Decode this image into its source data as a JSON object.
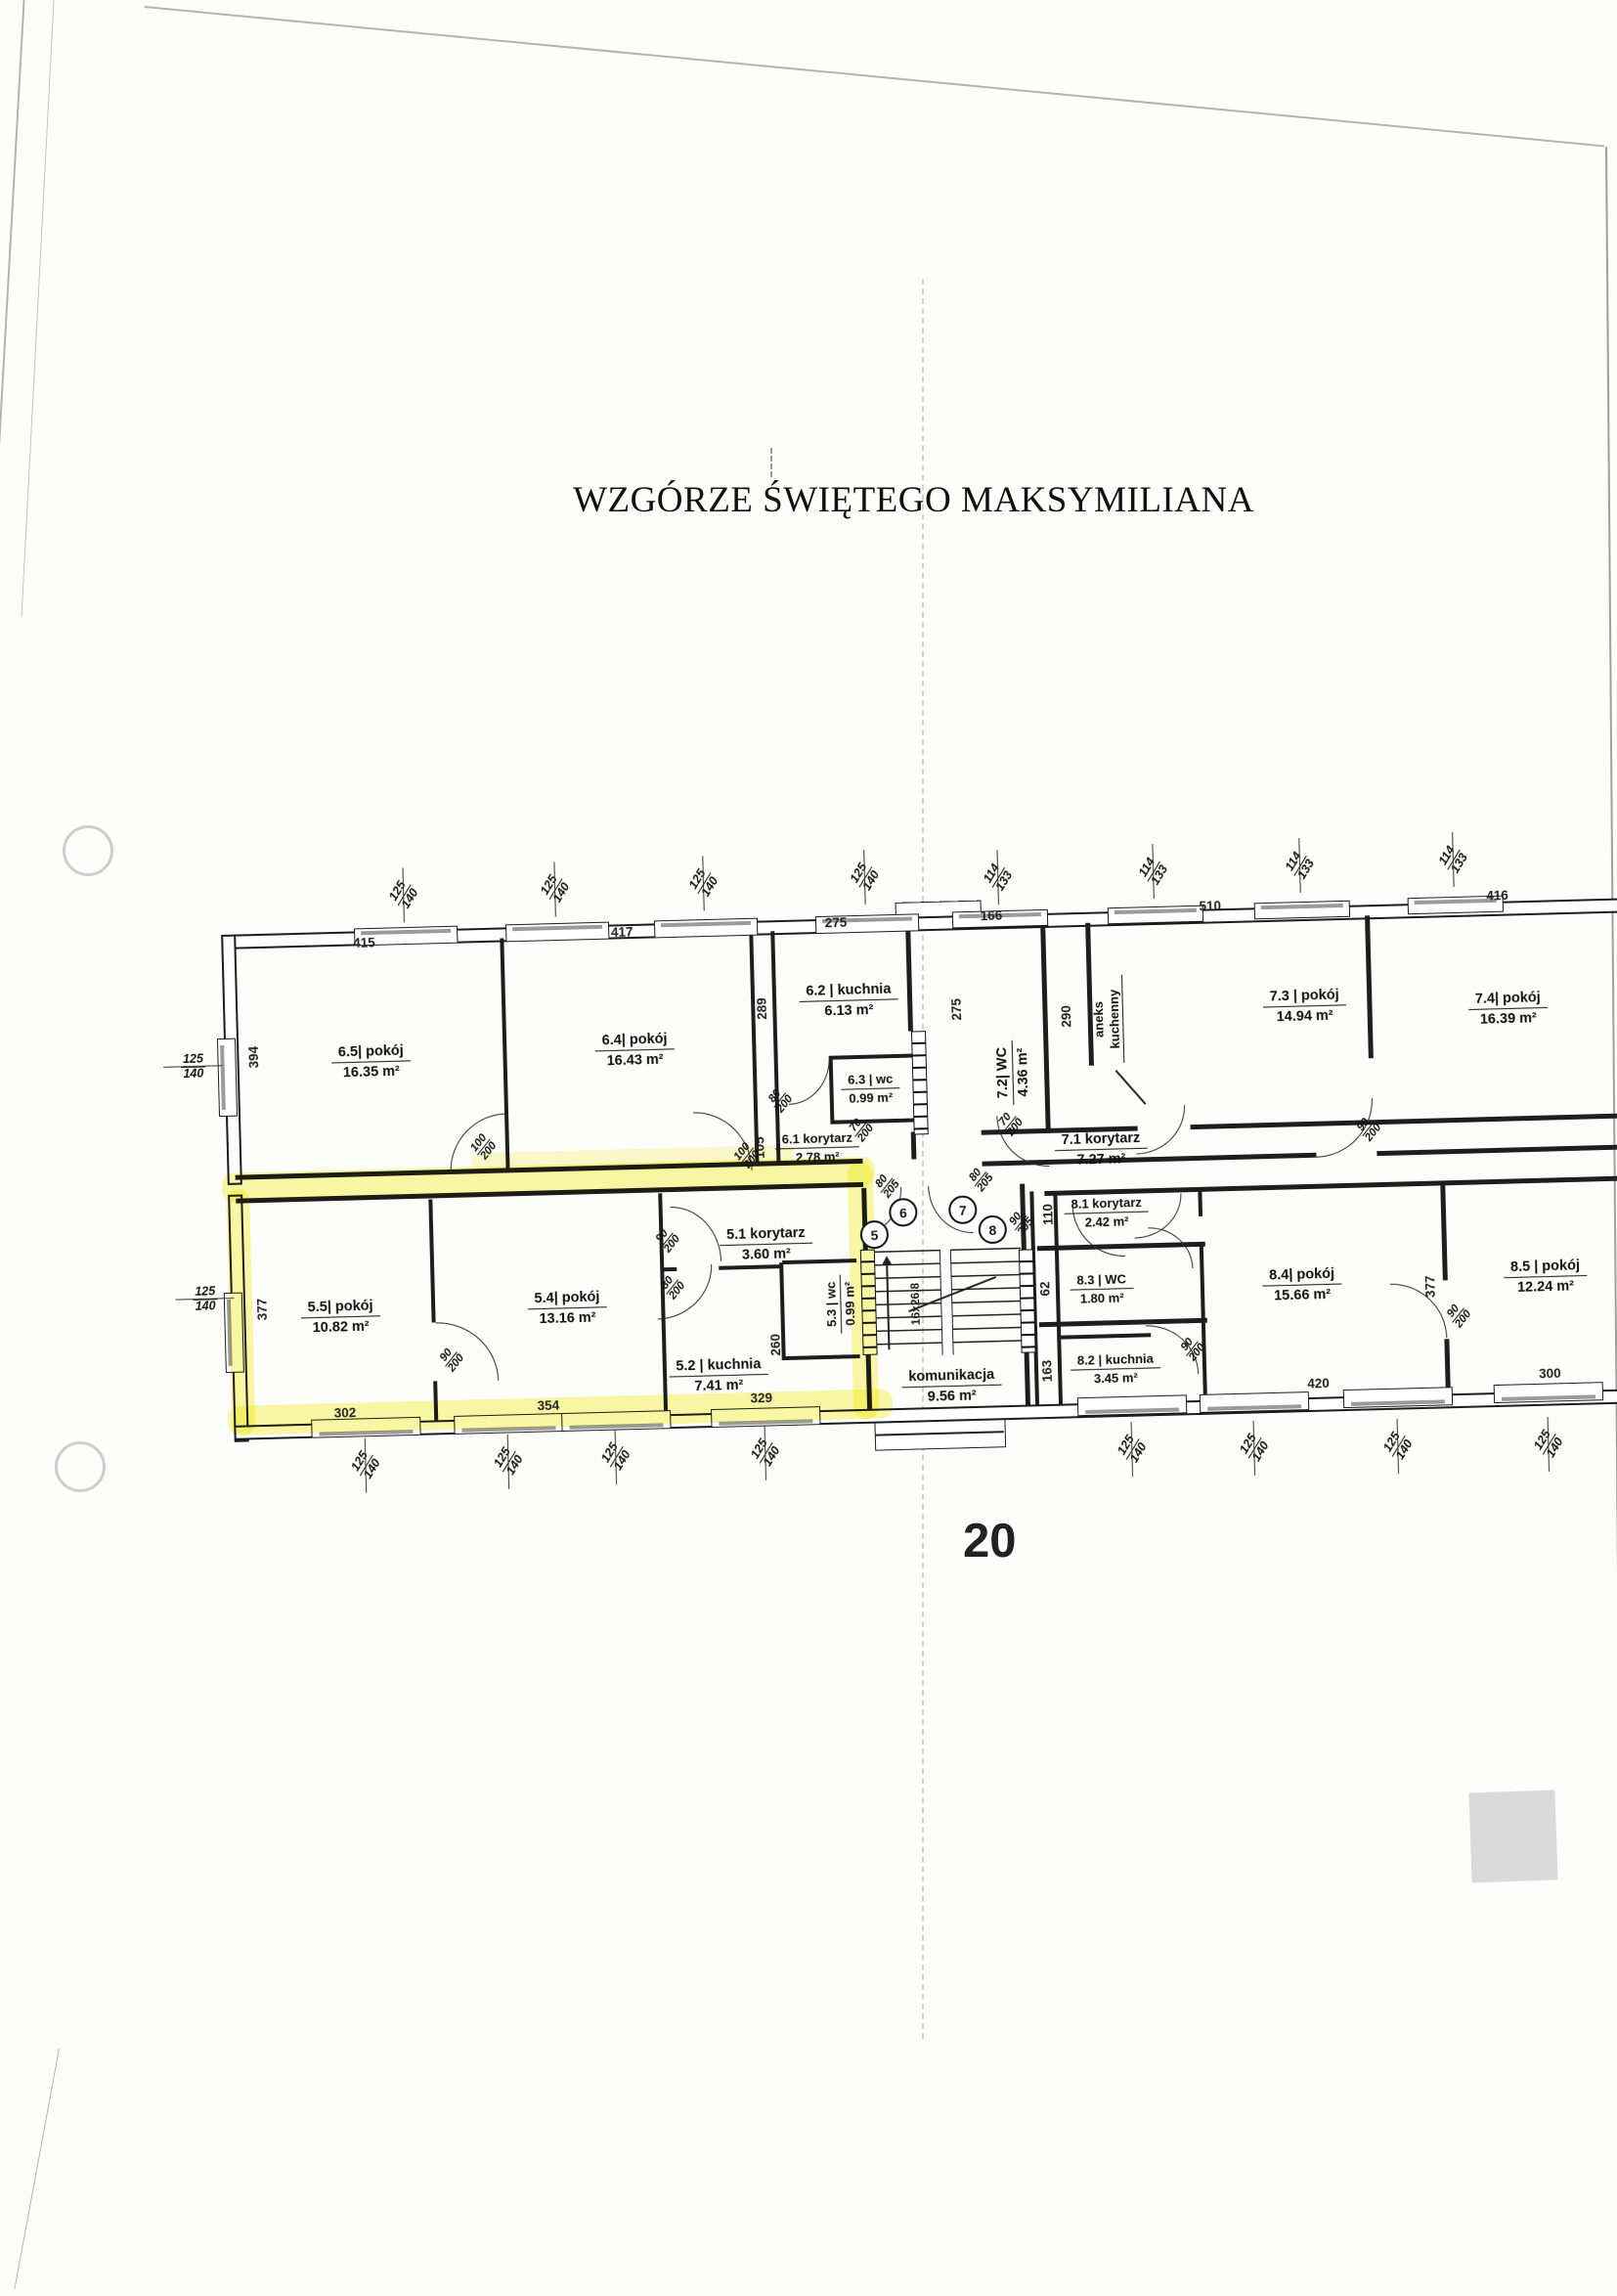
{
  "title": "WZGÓRZE ŚWIĘTEGO MAKSYMILIANA",
  "page_number": "20",
  "highlight_color": "#f3ef4e",
  "stair_note": "16x26,8",
  "entries": [
    "5",
    "6",
    "7",
    "8"
  ],
  "rooms": [
    {
      "name": "6.5| pokój",
      "area": "16.35 m²"
    },
    {
      "name": "6.4| pokój",
      "area": "16.43 m²"
    },
    {
      "name": "6.2 | kuchnia",
      "area": "6.13  m²"
    },
    {
      "name": "6.3 | wc",
      "area": "0.99 m²"
    },
    {
      "name": "6.1 korytarz",
      "area": "2.78 m²"
    },
    {
      "name": "7.2| WC",
      "area": "4.36  m²"
    },
    {
      "name": "7.3 | pokój",
      "area": "14.94 m²"
    },
    {
      "name": "7.1 korytarz",
      "area": "7.27 m²"
    },
    {
      "name": "7.4| pokój",
      "area": "16.39 m²"
    },
    {
      "name": "5.5| pokój",
      "area": "10.82 m²"
    },
    {
      "name": "5.4| pokój",
      "area": "13.16 m²"
    },
    {
      "name": "5.1 korytarz",
      "area": "3.60 m²"
    },
    {
      "name": "5.2 | kuchnia",
      "area": "7.41 m²"
    },
    {
      "name": "5.3 | wc",
      "area": "0.99 m²"
    },
    {
      "name": "8.1 korytarz",
      "area": "2.42 m²"
    },
    {
      "name": "8.3 | WC",
      "area": "1.80 m²"
    },
    {
      "name": "8.2 | kuchnia",
      "area": "3.45 m²"
    },
    {
      "name": "8.4| pokój",
      "area": "15.66 m²"
    },
    {
      "name": "8.5 | pokój",
      "area": "12.24 m²"
    },
    {
      "name": "aneks kuchenny",
      "area": ""
    },
    {
      "name": "komunikacja",
      "area": "9.56 m²"
    }
  ],
  "dims": {
    "t1": "415",
    "t2": "417",
    "t3": "275",
    "t4": "166",
    "t5": "510",
    "t6": "416",
    "b1": "302",
    "b2": "354",
    "b3": "329",
    "b4": "420",
    "b5": "300",
    "l1": "394",
    "l2": "377",
    "i1": "289",
    "i2": "105",
    "i3": "275",
    "i4": "290",
    "i5": "260",
    "i6": "110",
    "i7": "62",
    "i8": "163",
    "i9": "377"
  },
  "window_labels": {
    "a": {
      "num": "125",
      "den": "140"
    },
    "b": {
      "num": "114",
      "den": "133"
    }
  },
  "door_labels": {
    "d100_200": {
      "num": "100",
      "den": "200"
    },
    "d80_200": {
      "num": "80",
      "den": "200"
    },
    "d70_200": {
      "num": "70",
      "den": "200"
    },
    "d80_205": {
      "num": "80",
      "den": "205"
    },
    "d90_205": {
      "num": "90",
      "den": "205"
    },
    "d90_200": {
      "num": "90",
      "den": "200"
    }
  }
}
